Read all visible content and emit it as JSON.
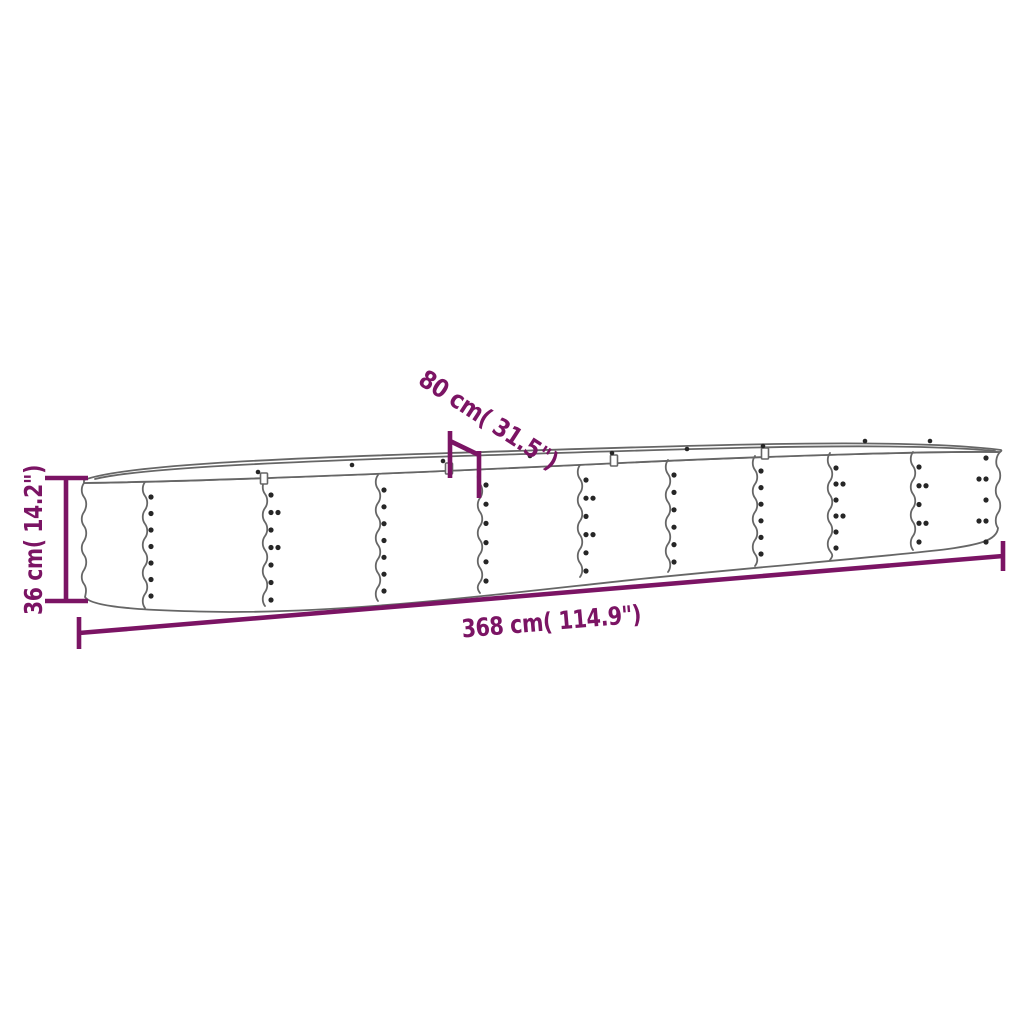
{
  "diagram": {
    "type": "product-dimension-drawing",
    "subject": "oval corrugated-steel raised garden bed, outline line-art with dimension arrows",
    "colors": {
      "background": "#ffffff",
      "dimension_annotation": "#7b1464",
      "product_outline": "#666666",
      "screw_dot": "#262626"
    },
    "dimensions": {
      "length": {
        "label": "368 cm( 114.9\")",
        "value_cm": 368,
        "value_inch": 114.9,
        "placement": "below product, slightly slanted"
      },
      "width": {
        "label": "80 cm( 31.5\")",
        "value_cm": 80,
        "value_inch": 31.5,
        "placement": "above product, rotated diagonal"
      },
      "height": {
        "label": "36 cm( 14.2\")",
        "value_cm": 36,
        "value_inch": 14.2,
        "placement": "left of product, rotated vertical"
      }
    }
  }
}
